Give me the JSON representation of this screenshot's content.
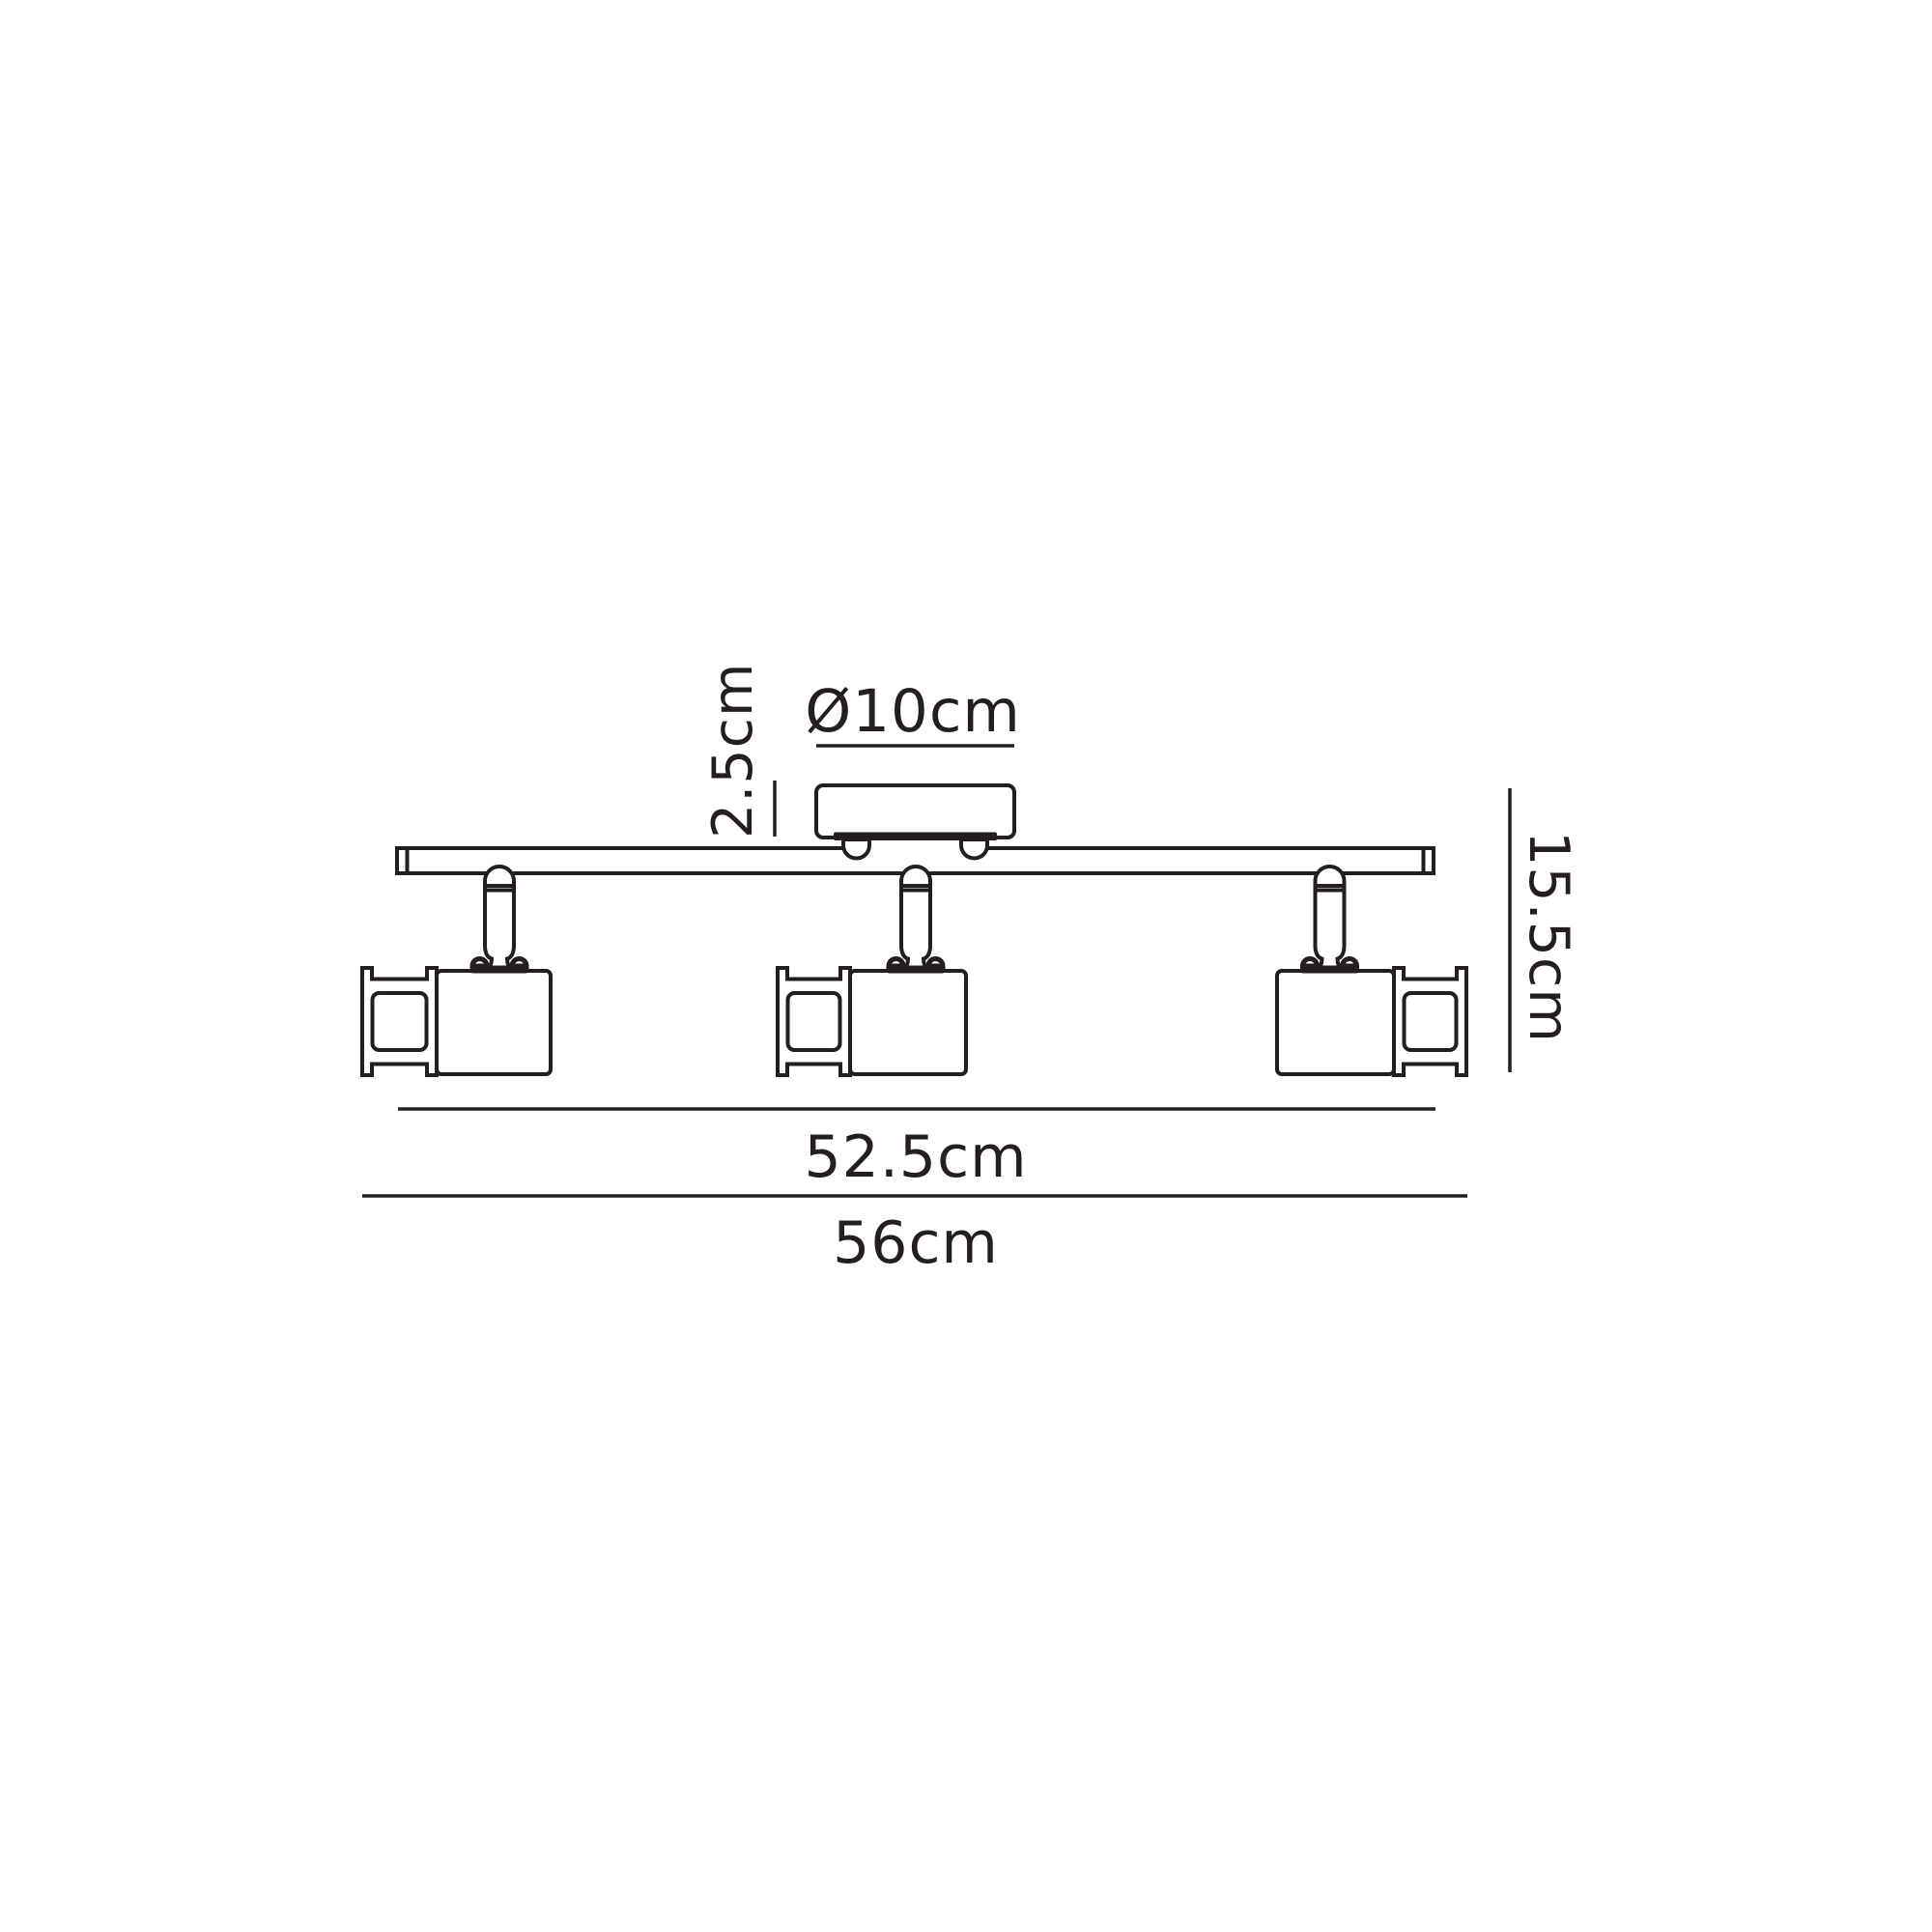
{
  "page": {
    "background": "#ffffff",
    "ink": "#231f20"
  },
  "diagram": {
    "kind": "spotlight-bar-dimension-drawing",
    "labels": {
      "canopy_diameter": "Ø10cm",
      "canopy_height": "2.5cm",
      "overall_height": "15.5cm",
      "bar_length": "52.5cm",
      "overall_width": "56cm"
    }
  }
}
